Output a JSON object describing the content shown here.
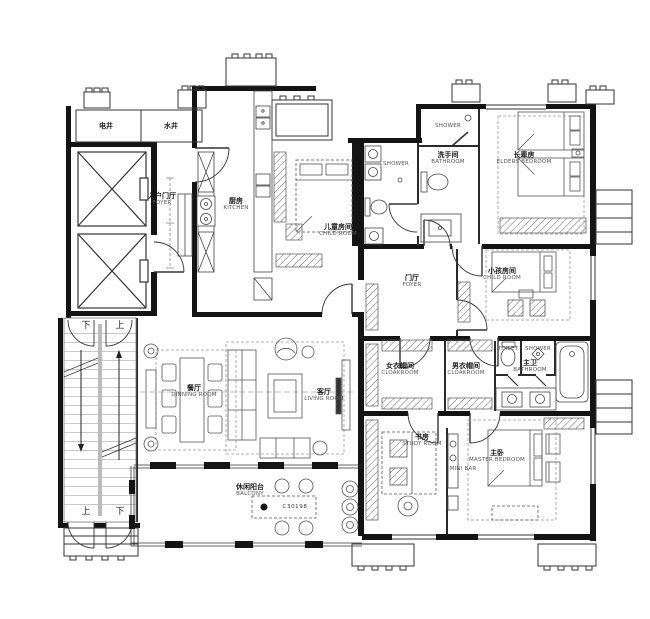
{
  "colors": {
    "wall": "#141414",
    "partition": "#2a2a2a",
    "line": "#444444",
    "furniture": "#555555",
    "dash": "#888888",
    "bg": "#ffffff"
  },
  "labels": [
    {
      "name": "shaft-electric-label",
      "cn": "电井",
      "en": "",
      "x": 106,
      "y": 126,
      "cls": ""
    },
    {
      "name": "shaft-water-label",
      "cn": "水井",
      "en": "",
      "x": 171,
      "y": 126,
      "cls": ""
    },
    {
      "name": "stair-top-down-label",
      "cn": "下",
      "en": "",
      "x": 86,
      "y": 326,
      "cls": "zh"
    },
    {
      "name": "stair-top-up-label",
      "cn": "上",
      "en": "",
      "x": 120,
      "y": 326,
      "cls": "zh"
    },
    {
      "name": "stair-bottom-up-label",
      "cn": "上",
      "en": "",
      "x": 86,
      "y": 512,
      "cls": "zh"
    },
    {
      "name": "stair-bottom-down-label",
      "cn": "下",
      "en": "",
      "x": 120,
      "y": 512,
      "cls": "zh"
    },
    {
      "name": "entry-foyer-label",
      "cn": "入户门厅",
      "en": "FOYER",
      "x": 162,
      "y": 199,
      "cls": ""
    },
    {
      "name": "kitchen-label",
      "cn": "厨房",
      "en": "KITCHEN",
      "x": 236,
      "y": 204,
      "cls": ""
    },
    {
      "name": "child-room-1-label",
      "cn": "儿童房间",
      "en": "CHILD ROOM",
      "x": 338,
      "y": 230,
      "cls": ""
    },
    {
      "name": "shower-room-label",
      "cn": "",
      "en": "SHOWER",
      "x": 396,
      "y": 164,
      "cls": ""
    },
    {
      "name": "bathroom-1-shower-label",
      "cn": "",
      "en": "SHOWER",
      "x": 448,
      "y": 126,
      "cls": ""
    },
    {
      "name": "bathroom-1-label",
      "cn": "洗手间",
      "en": "BATHROOM",
      "x": 448,
      "y": 158,
      "cls": ""
    },
    {
      "name": "elders-bedroom-label",
      "cn": "长辈房",
      "en": "ELDERS BEDROOM",
      "x": 524,
      "y": 158,
      "cls": ""
    },
    {
      "name": "foyer-label",
      "cn": "门厅",
      "en": "FOYER",
      "x": 412,
      "y": 281,
      "cls": ""
    },
    {
      "name": "child-room-2-label",
      "cn": "小孩房间",
      "en": "CHILD ROOM",
      "x": 502,
      "y": 274,
      "cls": ""
    },
    {
      "name": "cloakroom-women-label",
      "cn": "女衣帽间",
      "en": "CLOAKROOM",
      "x": 400,
      "y": 369,
      "cls": ""
    },
    {
      "name": "cloakroom-men-label",
      "cn": "男衣帽间",
      "en": "CLOAKROOM",
      "x": 466,
      "y": 369,
      "cls": ""
    },
    {
      "name": "toilet-label",
      "cn": "",
      "en": "TOILET",
      "x": 508,
      "y": 349,
      "cls": ""
    },
    {
      "name": "shower-2-label",
      "cn": "",
      "en": "SHOWER",
      "x": 538,
      "y": 349,
      "cls": ""
    },
    {
      "name": "master-bathroom-label",
      "cn": "主卫",
      "en": "BATHROOM",
      "x": 530,
      "y": 366,
      "cls": ""
    },
    {
      "name": "dining-room-label",
      "cn": "餐厅",
      "en": "DINNING ROOM",
      "x": 194,
      "y": 391,
      "cls": ""
    },
    {
      "name": "living-room-label",
      "cn": "客厅",
      "en": "LIVING ROOM",
      "x": 324,
      "y": 395,
      "cls": ""
    },
    {
      "name": "study-room-label",
      "cn": "书房",
      "en": "STUDY ROOM",
      "x": 422,
      "y": 440,
      "cls": ""
    },
    {
      "name": "mini-bar-label",
      "cn": "",
      "en": "MINI BAR",
      "x": 463,
      "y": 469,
      "cls": ""
    },
    {
      "name": "master-bedroom-label",
      "cn": "主卧",
      "en": "MASTER BEDROOM",
      "x": 497,
      "y": 456,
      "cls": ""
    },
    {
      "name": "balcony-label",
      "cn": "休闲阳台",
      "en": "BALCONY",
      "x": 250,
      "y": 490,
      "cls": ""
    },
    {
      "name": "table-code-label",
      "cn": "",
      "en": "C30198",
      "x": 295,
      "y": 507,
      "cls": "code"
    }
  ]
}
